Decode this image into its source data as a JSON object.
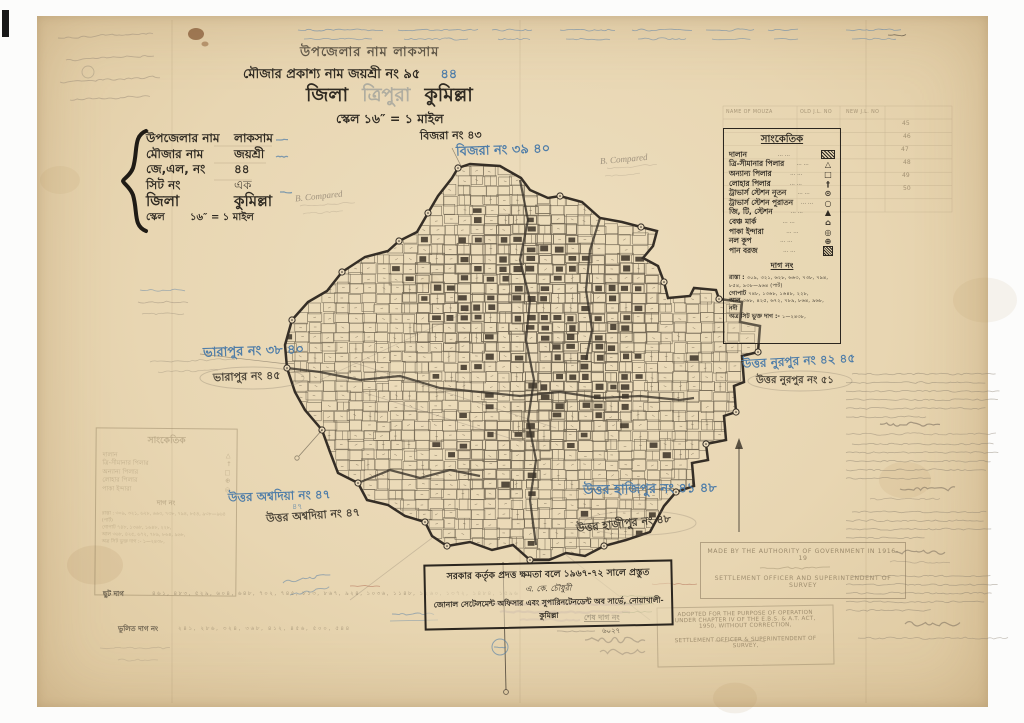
{
  "colors": {
    "paper": "#e8d7b5",
    "ink": "#2f2a22",
    "blue": "#4f7da8",
    "pencil": "#8d8170",
    "faded_stamp": "#8d7c5f",
    "map_ink": "#3a332a",
    "red": "#a4543f",
    "purple": "#8a6f94",
    "green": "#5c7a4e"
  },
  "header": {
    "line1": "উপজেলার নাম লাকসাম",
    "line2": "মৌজার প্রকাশ্য নাম জয়শ্রী নং ৯৫",
    "line2_blue": "৪৪",
    "line3_prefix": "জিলা",
    "line3_struck": "ত্রিপুরা",
    "line3_suffix": "কুমিল্লা",
    "line4": "স্কেল ১৬″ = ১ মাইল"
  },
  "info_box": {
    "rows": [
      {
        "label": "উপজেলার নাম",
        "value": "লাকসাম"
      },
      {
        "label": "মৌজার নাম",
        "value": "জয়শ্রী"
      },
      {
        "label": "জে,এল, নং",
        "value": "৪৪"
      },
      {
        "label": "সিট নং",
        "value": "এক"
      },
      {
        "label": "জিলা",
        "value": "কুমিল্লা"
      },
      {
        "label": "স্কেল",
        "value": "১৬″ = ১ মাইল"
      }
    ]
  },
  "legend": {
    "title": "সাংকেতিক",
    "leader": "··· ···",
    "items": [
      {
        "label": "দালান",
        "glyph": "",
        "icon": "building-icon"
      },
      {
        "label": "ত্রি-সীমানার পিলার",
        "glyph": "△",
        "icon": "tri-boundary-pillar-icon"
      },
      {
        "label": "অন্যান্য পিলার",
        "glyph": "□",
        "icon": "other-pillar-icon"
      },
      {
        "label": "লোহার পিলার",
        "glyph": "†",
        "icon": "iron-pillar-icon"
      },
      {
        "label": "ট্রাভার্স স্টেশন নূতন",
        "glyph": "⊙",
        "icon": "traverse-station-new-icon"
      },
      {
        "label": "ট্রাভার্স স্টেশন পুরাতন",
        "glyph": "○",
        "icon": "traverse-station-old-icon"
      },
      {
        "label": "জি, টি, স্টেশন",
        "glyph": "▲",
        "icon": "gt-station-icon"
      },
      {
        "label": "বেঞ্চ মার্ক",
        "glyph": "⌂",
        "icon": "bench-mark-icon"
      },
      {
        "label": "পাকা ইন্দারা",
        "glyph": "◎",
        "icon": "masonry-well-icon"
      },
      {
        "label": "নল কূপ",
        "glyph": "⊕",
        "icon": "tube-well-icon"
      },
      {
        "label": "পান বরজ",
        "glyph": "",
        "icon": "betel-garden-icon"
      }
    ],
    "dag_title": "দাগ নং",
    "dag_rows": [
      {
        "label": "রাস্তা :",
        "numbers": "৩০৯, ৩২১, ৬২৮, ৬৬৩, ৭৩৮, ৭৯৪, ৮৫৪, ৯৩৮—৯৬৪ (পার্ট)"
      },
      {
        "label": "গোপাট",
        "numbers": "৭৪৮, ১৩৬৮, ১৬৪৮, ২২৮,"
      },
      {
        "label": "আল",
        "numbers": "৩৬৮, ৪২৫, ৬৭২, ৭৮৯, ৮৬৪, ৯৬৮,"
      },
      {
        "label": "নদী",
        "numbers": ""
      },
      {
        "label": "অত্র সিট ভুক্ত দাগ :-",
        "numbers": "১—২৪৩৮,"
      }
    ]
  },
  "neighbors": {
    "top_black": "বিজরা নং ৪৩",
    "top_blue": "বিজরা নং ৩৯ ৪০",
    "left_blue": "ভারাপুর নং ৩৮ ৪০",
    "left_black": "ভারাপুর নং ৪৫",
    "right_blue": "উত্তর নুরপুর নং ৪২ ৪৫",
    "right_black": "উত্তর নুরপুর নং ৫১",
    "bottom_left_blue": "উত্তর অশ্বদিয়া নং ৪৭",
    "bottom_left_extra": "৪৭",
    "bottom_left_black": "উত্তর অশ্বদিয়া নং ৪৭",
    "bottom_right_blue": "উত্তর হাজিপুর নং ৪১ ৪৮",
    "bottom_right_black": "উত্তর হাজীপুর নং ৪৮"
  },
  "stamp": {
    "line1": "সরকার কর্তৃক প্রদত্ত ক্ষমতা বলে ১৯৬৭-৭২ সালে প্রস্তুত",
    "signature": "এ. কে. চৌধুরী",
    "line2": "জোনাল সেটেলমেন্ট অফিসার এবং সুপারিনটেনডেন্ট অব সার্ভে, নোয়াখালী-কুমিল্লা"
  },
  "stamps_en": {
    "box1": {
      "line1": "MADE BY THE AUTHORITY OF GOVERNMENT IN 1916-19",
      "line2": "SETTLEMENT OFFICER AND SUPERINTENDENT OF SURVEY"
    },
    "box2": {
      "line1": "ADOPTED FOR THE PURPOSE OF OPERATION",
      "line2": "UNDER CHAPTER IV OF THE E.B.S. & A.T. ACT,",
      "line3": "1950, WITHOUT CORRECTION,",
      "line4": "SETTLEMENT OFFICER & SUPERINTENDENT OF",
      "line5": "SURVEY,"
    }
  },
  "plot_rows": {
    "chhut_label": "ছুট দাগ",
    "chhut_numbers": "৪৬১, ৪৮৩, ৫২৯, ৬০৪, ৬৪৮, ৭০২, ৭৪৫, ৮১৩, ৮৬৭, ৯২৪, ১০৩৬, ১১৪৮, ১২৬০, ১৩৭২, ১৪৮৪, ১৫৯৬",
    "bhulito_label": "ভুলিত দাগ নং",
    "bhulito_numbers": "২৪১, ২৮৬, ৩২৪, ৩৬৮, ৪১২, ৪৫৬, ৫০০, ৫৪৪",
    "shesh_label": "শেষ দাগ নং",
    "shesh_value": "৬০২৭"
  },
  "ref_table": {
    "headers": [
      "NAME OF MOUZA",
      "OLD J.L. NO",
      "NEW J.L. NO"
    ],
    "rows": [
      "45",
      "46",
      "47",
      "48",
      "49",
      "50"
    ]
  },
  "misc": {
    "compared": "B. Compared"
  }
}
